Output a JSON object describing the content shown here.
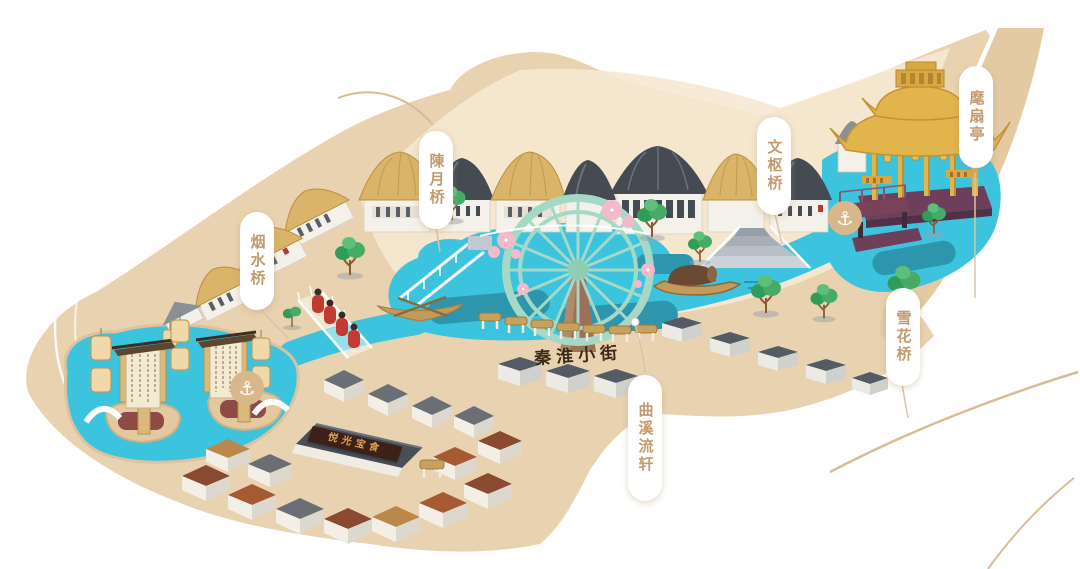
{
  "meta": {
    "kind": "illustrated-theme-park-map",
    "canvas_width": 1080,
    "canvas_height": 569
  },
  "labels": {
    "huishan_pavilion": "麾扇亭",
    "wenshu_bridge": "文枢桥",
    "chenyue_bridge": "陳月桥",
    "yanshui_bridge": "烟水桥",
    "xuehua_bridge": "雪花桥",
    "quxi_liuxuan": "曲溪流轩",
    "qinhuai_street": "秦淮小街",
    "sign_board": "悦光宝食"
  },
  "icons": {
    "anchor": "⚓"
  },
  "features": [
    "waterwheel",
    "golden-pavilion",
    "canopy-boat",
    "row-boat",
    "glass-walkway",
    "red-robed-figures",
    "scroll-stage",
    "hanging-lanterns",
    "covered-bridges",
    "market-stalls",
    "village-houses",
    "stepped-terrace",
    "trees",
    "blossoms",
    "dock-anchor-markers"
  ],
  "colors": {
    "background": "#ffffff",
    "land": "#e9d2b0",
    "plaza": "#f6e8d1",
    "wedge": "#e3caa2",
    "water": "#3cc3de",
    "water_dark": "#2d95ac",
    "roof_tan": "#d9b469",
    "roof_dark": "#454b53",
    "wall_white": "#f4f1ea",
    "wheel_mint": "#a5d9c5",
    "pavilion_gold": "#e2b44c",
    "deck_purple": "#6e3f5a",
    "tree_green": "#47ab67",
    "blossom_pink": "#f3b9cd",
    "figure_red": "#c23a32",
    "label_text": "#c49a6d",
    "street_text": "#3a2a17",
    "sign_board": "#3d2118",
    "sign_text": "#daa055",
    "anchor_badge": "#d8b88a",
    "boat_wood": "#c29a5c",
    "canopy_brown": "#6b4a33"
  }
}
